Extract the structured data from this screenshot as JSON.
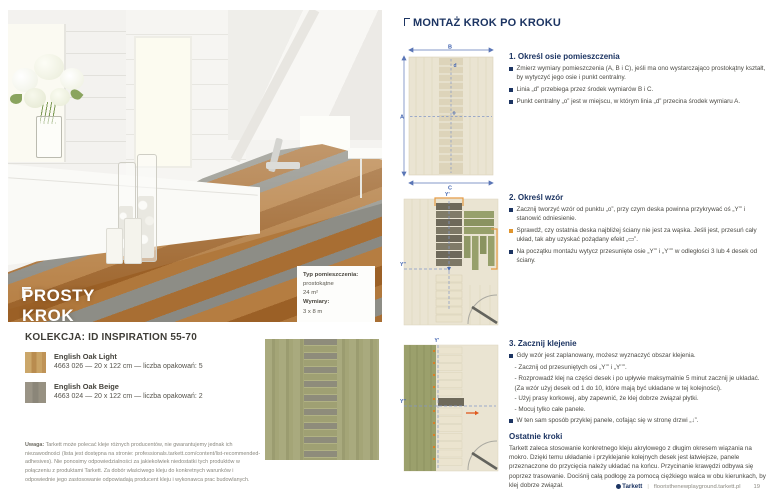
{
  "left_page": {
    "hero_title": "PROSTY KROK",
    "room_box": {
      "label": "Typ pomieszczenia:",
      "type": "prostokątne",
      "area": "24 m²",
      "dims_label": "Wymiary:",
      "dims": "3 x 8 m"
    },
    "collection": {
      "title": "KOLEKCJA: ID INSPIRATION 55-70",
      "products": [
        {
          "name": "English Oak Light",
          "details": "4663 026 — 20 x 122 cm — liczba opakowań: 5",
          "swatch_color": "#c9a468"
        },
        {
          "name": "English Oak Beige",
          "details": "4663 024 — 20 x 122 cm — liczba opakowań: 2",
          "swatch_color": "#96917f"
        }
      ]
    },
    "note_label": "Uwaga:",
    "note_text": "Tarkett może polecać kleje różnych producentów, nie gwarantujemy jednak ich niezawodności (lista jest dostępna na stronie: professionals.tarkett.com/content/list-recommended-adhesives). Nie ponosimy odpowiedzialności za jakiekolwiek niedostatki tych produktów w połączeniu z produktami Tarkett. Za dobór właściwego kleju do konkretnych warunków i odpowiednie jego zastosowanie odpowiadają producent kleju i wykonawca prac budowlanych."
  },
  "right_page": {
    "title": "MONTAŻ KROK PO KROKU",
    "diagram_labels": {
      "a": "A",
      "b": "B",
      "c": "C",
      "d": "d",
      "o": "o",
      "y1": "Y’",
      "y2": "Y’’"
    },
    "steps": [
      {
        "heading": "1. Określ osie pomieszczenia",
        "bullets": [
          {
            "text": "Zmierz wymiary pomieszczenia (A, B i C), jeśli ma ono wystarczająco prostokątny kształt, by wytyczyć jego osie i punkt centralny."
          },
          {
            "text": "Linia „d” przebiega przez środek wymiarów B i C."
          },
          {
            "text": "Punkt centralny „o” jest w miejscu, w którym linia „d” przecina środek wymiaru A."
          }
        ]
      },
      {
        "heading": "2. Określ wzór",
        "bullets": [
          {
            "text": "Zacznij tworzyć wzór od punktu „o”, przy czym deska powinna przykrywać oś „Y’” i stanowić odniesienie."
          },
          {
            "text": "Sprawdź, czy ostatnia deska najbliżej ściany nie jest za wąska. Jeśli jest, przesuń cały układ, tak aby uzyskać pożądany efekt „▭”."
          },
          {
            "text": "Na początku montażu wytycz przesunięte osie „Y’” i „Y’’” w odległości 3 lub 4 desek od ściany."
          }
        ]
      },
      {
        "heading": "3. Zacznij klejenie",
        "bullets": [
          {
            "text": "Gdy wzór jest zaplanowany, możesz wyznaczyć obszar klejenia."
          },
          {
            "text": "- Zacznij od przesuniętych osi „Y’” i „Y’’”."
          },
          {
            "text": "- Rozprowadź klej na części desek i po upływie maksymalnie 5 minut zacznij je układać."
          },
          {
            "text": "(Za wzór użyj desek od 1 do 10, które mają być układane w tej kolejności)."
          },
          {
            "text": "- Użyj prasy korkowej, aby zapewnić, że klej dobrze związał płytki."
          },
          {
            "text": "- Mocuj tylko całe panele."
          },
          {
            "text": "W ten sam sposób przyklej panele, cofając się w stronę drzwi „↓”."
          }
        ]
      }
    ],
    "final_heading": "Ostatnie kroki",
    "final_text": "Tarkett zaleca stosowanie konkretnego kleju akrylowego z długim okresem wiązania na mokro. Dzięki temu układanie i przyklejanie kolejnych desek jest łatwiejsze, panele przeznaczone do przycięcia należy układać na końcu. Przycinanie krawędzi odbywa się poprzez trasowanie. Dociśnij całą podłogę za pomocą ciężkiego walca w obu kierunkach, by klej dobrze związał."
  },
  "footer": {
    "brand": "Tarkett",
    "url": "flooristhenewplayground.tarkett.pl",
    "page": "19"
  },
  "colors": {
    "navy": "#1c3462",
    "diagram_blue": "#3c5fae",
    "orange": "#e0952e",
    "arrow_orange": "#df5a1f"
  }
}
